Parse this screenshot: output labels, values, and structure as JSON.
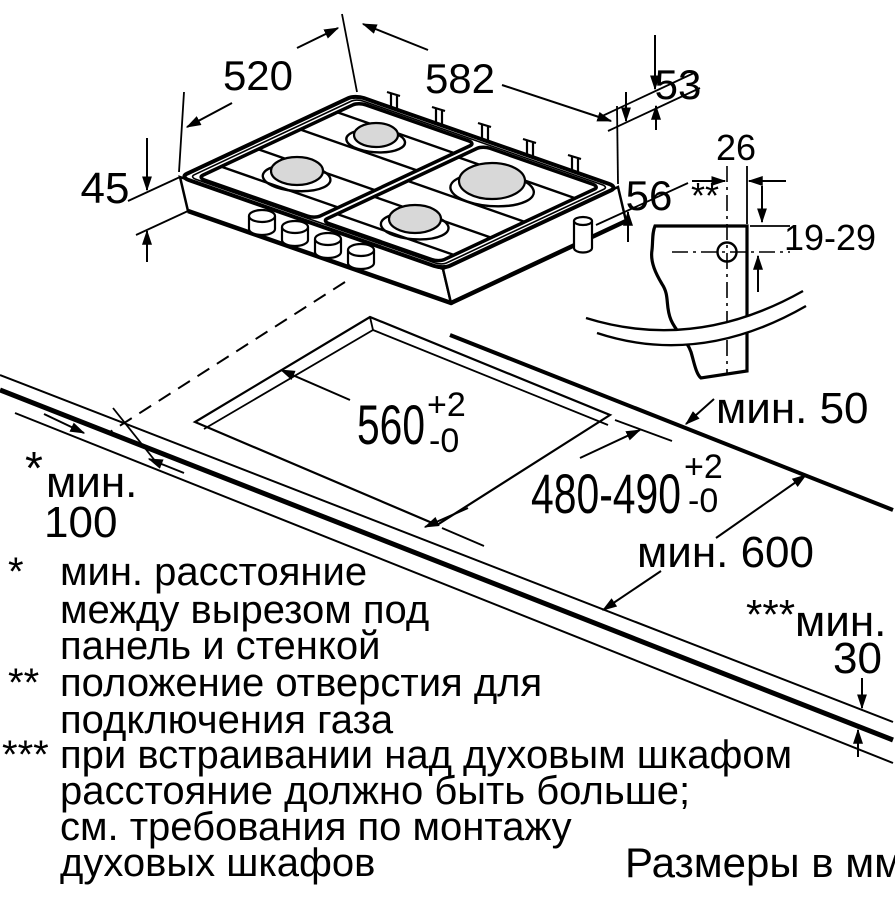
{
  "colors": {
    "line": "#000000",
    "background": "#ffffff",
    "burner_cap": "#d8d8d8"
  },
  "caption": "Размеры в мм",
  "dims": {
    "hob_depth": "520",
    "hob_width": "582",
    "right_edge_offset": "53",
    "hob_rim_height": "45",
    "hob_body_height": "56",
    "gas_hole_offset": "26",
    "gas_hole_marker": "**",
    "gas_hole_vertical_range": "19-29",
    "cutout_width": "560",
    "cutout_width_tol_plus": "+2",
    "cutout_width_tol_minus": "-0",
    "cutout_depth": "480-490",
    "cutout_depth_tol_plus": "+2",
    "cutout_depth_tol_minus": "-0",
    "min_back_clearance": "мин. 50",
    "min_worktop_depth": "мин. 600",
    "min_side_marker": "*",
    "min_side_word": "мин.",
    "min_side_value": "100",
    "min_thickness_marker": "***",
    "min_thickness_word": "мин.",
    "min_thickness_value": "30"
  },
  "footnotes": {
    "f1_marker": "*",
    "f1_line1": "мин. расстояние",
    "f1_line2": "между вырезом под",
    "f1_line3": "панель и стенкой",
    "f2_marker": "**",
    "f2_line1": "положение отверстия для",
    "f2_line2": "подключения газа",
    "f3_marker": "***",
    "f3_line1": "при встраивании над духовым шкафом",
    "f3_line2": "расстояние должно быть больше;",
    "f3_line3": "см. требования по монтажу",
    "f3_line4": "духовых шкафов"
  }
}
